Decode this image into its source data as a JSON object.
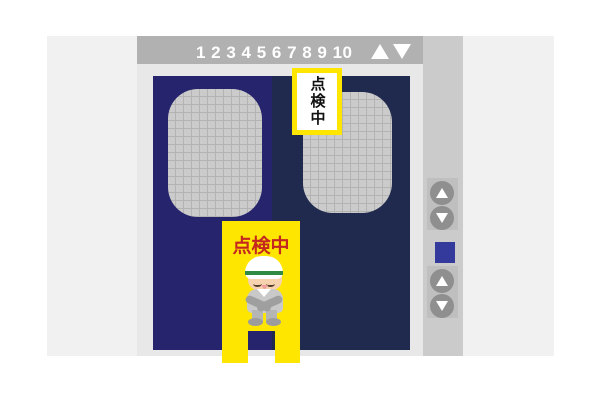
{
  "floor_indicator": {
    "floors": [
      "1",
      "2",
      "3",
      "4",
      "5",
      "6",
      "7",
      "8",
      "9",
      "10"
    ],
    "floors_display": "1 2 3 4 5 6 7 8 9 10",
    "arrows": [
      {
        "icon": "up-triangle",
        "glyph": "▲",
        "color": "#ffffff"
      },
      {
        "icon": "down-triangle",
        "glyph": "▼",
        "color": "#ffffff"
      }
    ]
  },
  "door_sign": {
    "text": "点検中",
    "orientation": "vertical",
    "text_color": "#111111",
    "border_color": "#ffe600"
  },
  "stand_sign": {
    "text": "点検中",
    "text_color": "#c3271f",
    "stand_color": "#ffe600"
  },
  "call_panel": {
    "upper_buttons": [
      {
        "icon": "up-triangle",
        "glyph": "▲"
      },
      {
        "icon": "down-triangle",
        "glyph": "▼"
      }
    ],
    "indicator": {
      "color": "#333a9b"
    },
    "lower_buttons": [
      {
        "icon": "up-triangle",
        "glyph": "▲"
      },
      {
        "icon": "down-triangle",
        "glyph": "▼"
      }
    ]
  },
  "colors": {
    "page_background": "#ffffff",
    "wall_background": "#f1f1f1",
    "elevator_frame": "#e8e8e8",
    "indicator_bar": "#b1b1b1",
    "left_door": "#26246d",
    "right_door": "#1f2a4e",
    "window_mesh": "#cbcbcb",
    "window_grid_line": "#b3b3b3",
    "button_circle": "#8f8f8f",
    "panel_strip": "#cbcbcb",
    "panel_plate": "#bfbfbf",
    "helmet_stripe_green": "#2f8b44"
  }
}
